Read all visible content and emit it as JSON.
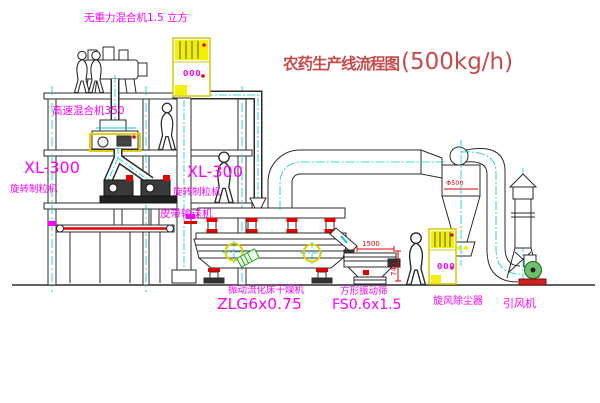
{
  "title": {
    "name": "农药生产线流程图",
    "capacity": "(500kg/h)"
  },
  "equipment_labels": {
    "gravity_mixer": "无重力混合机1.5 立方",
    "high_speed_mixer": "高速混合机350",
    "granulator_left_model": "XL-300",
    "granulator_left_name": "旋转制粒机",
    "granulator_right_model": "XL-300",
    "granulator_right_name": "旋转制粒机",
    "belt_conveyor": "皮带输送机",
    "dryer_name": "振动流化床干燥机",
    "dryer_model": "ZLG6x0.75",
    "sieve_name": "方形振动筛",
    "sieve_model": "FS0.6x1.5",
    "cyclone": "旋风除尘器",
    "fan": "引风机"
  },
  "dimensions": {
    "sieve_length": "1500",
    "sieve_height": "740",
    "cyclone_diameter": "Φ500"
  },
  "control_cabinet_display": "000",
  "colors": {
    "label_magenta": "#ff00ff",
    "title_red": "#c74b4b",
    "dimension_red": "#e60000",
    "line_dark": "#2b2b2b",
    "centerline_cyan": "#00cccc",
    "equipment_yellow": "#f2f200",
    "accent_green": "#2ba52b",
    "background": "#ffffff"
  }
}
